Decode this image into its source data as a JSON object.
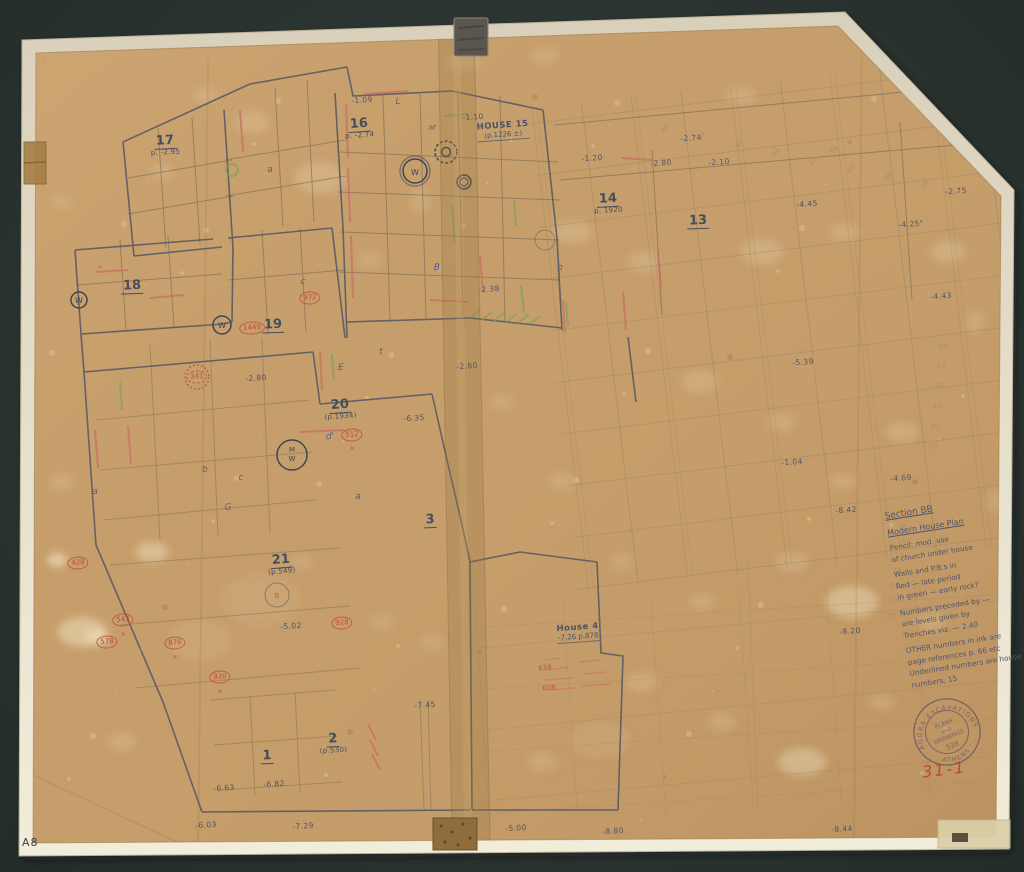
{
  "artifact": {
    "corner_label": "A8",
    "catalog_red": "31-1",
    "stamp": {
      "arc_top": "AGORA EXCAVATIONS",
      "arc_bottom": "· ATHENS ·",
      "line1": "PLANS",
      "line2": "AND",
      "line3": "DRAWINGS",
      "number": "538"
    }
  },
  "colors": {
    "paper": "#c69e6b",
    "border": "#e9e2cf",
    "ink": "#4b5263",
    "pencil": "#6e6452",
    "red_ink": "#bf4136",
    "green_ink": "#7aa05e",
    "stamp_ink": "#6b5a6e"
  },
  "notes": {
    "lines": [
      {
        "t": "Section BB",
        "u": 1,
        "s": 9
      },
      {
        "t": ""
      },
      {
        "t": "Modern House Plan",
        "u": 1,
        "s": 8
      },
      {
        "t": ""
      },
      {
        "t": "Pencil: mod. use"
      },
      {
        "t": "of church under house"
      },
      {
        "t": ""
      },
      {
        "t": "Walls and P.B.s in"
      },
      {
        "t": "Red — late period"
      },
      {
        "t": "in green — early rock?"
      },
      {
        "t": ""
      },
      {
        "t": "Numbers preceded by —"
      },
      {
        "t": "are levels given by"
      },
      {
        "t": "Trenches  viz. — 2.40"
      },
      {
        "t": ""
      },
      {
        "t": "OTHER numbers in ink are"
      },
      {
        "t": "page references  p. 66 etc"
      },
      {
        "t": "Underlined numbers are house"
      },
      {
        "t": "numbers,  15"
      }
    ]
  },
  "plan": {
    "houses": [
      {
        "text": "17",
        "sub": "p. -2.95",
        "x": 165,
        "y": 143,
        "rot": -3
      },
      {
        "text": "16",
        "sub": "p. -2.74",
        "x": 359,
        "y": 126,
        "rot": -4
      },
      {
        "text": "14",
        "sub": "p. 1920",
        "x": 608,
        "y": 201,
        "rot": -3
      },
      {
        "text": "13",
        "x": 698,
        "y": 219,
        "rot": -2
      },
      {
        "text": "18",
        "x": 132,
        "y": 284,
        "rot": -2
      },
      {
        "text": "19",
        "x": 273,
        "y": 323,
        "rot": -2
      },
      {
        "text": "20",
        "sub": "(p.1934)",
        "x": 340,
        "y": 407,
        "rot": -4
      },
      {
        "text": "21",
        "sub": "(p.549)",
        "x": 281,
        "y": 562,
        "rot": -5
      },
      {
        "text": "3",
        "x": 430,
        "y": 518,
        "rot": -2
      },
      {
        "text": "2",
        "sub": "(p.530)",
        "x": 333,
        "y": 741,
        "rot": -3
      },
      {
        "text": "1",
        "x": 267,
        "y": 754,
        "rot": -2
      }
    ],
    "house_labels": [
      {
        "text": "HOUSE 15",
        "sub": "(p.1226 ±)",
        "x": 503,
        "y": 131,
        "rot": -4
      },
      {
        "text": "House 4",
        "sub": "-7.26  p.878",
        "x": 578,
        "y": 633,
        "rot": -4
      }
    ],
    "elevations": [
      {
        "text": "-1.09",
        "x": 362,
        "y": 100
      },
      {
        "text": "-1.10",
        "x": 473,
        "y": 117
      },
      {
        "text": "-1.20",
        "x": 592,
        "y": 158
      },
      {
        "text": "-2.80",
        "x": 661,
        "y": 163
      },
      {
        "text": "-2.10",
        "x": 719,
        "y": 162
      },
      {
        "text": "-2.74",
        "x": 691,
        "y": 138
      },
      {
        "text": "-2.75",
        "x": 956,
        "y": 191
      },
      {
        "text": "-4.45",
        "x": 807,
        "y": 204
      },
      {
        "text": "-4.25\"",
        "x": 911,
        "y": 224
      },
      {
        "text": "-4.43",
        "x": 941,
        "y": 296
      },
      {
        "text": "-5.39",
        "x": 803,
        "y": 362
      },
      {
        "text": "-1.04",
        "x": 792,
        "y": 462
      },
      {
        "text": "-4.69",
        "x": 901,
        "y": 478
      },
      {
        "text": "-8.42",
        "x": 846,
        "y": 510
      },
      {
        "text": "-8.20",
        "x": 850,
        "y": 631
      },
      {
        "text": "-2.38",
        "x": 489,
        "y": 289
      },
      {
        "text": "-2.80",
        "x": 467,
        "y": 366
      },
      {
        "text": "-2.80",
        "x": 256,
        "y": 378
      },
      {
        "text": "-6.35",
        "x": 414,
        "y": 418
      },
      {
        "text": "-5.02",
        "x": 291,
        "y": 626
      },
      {
        "text": "-6.63",
        "x": 224,
        "y": 788
      },
      {
        "text": "-6.82",
        "x": 274,
        "y": 784
      },
      {
        "text": "-6.03",
        "x": 206,
        "y": 825
      },
      {
        "text": "-7.29",
        "x": 303,
        "y": 826
      },
      {
        "text": "-7.45",
        "x": 425,
        "y": 705
      },
      {
        "text": "-5.00",
        "x": 516,
        "y": 828
      },
      {
        "text": "-8.80",
        "x": 613,
        "y": 831
      },
      {
        "text": "-8.44",
        "x": 842,
        "y": 829
      }
    ],
    "finds": [
      {
        "text": "341",
        "x": 197,
        "y": 377,
        "dotted": true
      },
      {
        "text": "1449",
        "x": 252,
        "y": 328
      },
      {
        "text": "972",
        "x": 310,
        "y": 298
      },
      {
        "text": "512",
        "x": 352,
        "y": 435
      },
      {
        "text": "428",
        "x": 78,
        "y": 563
      },
      {
        "text": "543",
        "x": 123,
        "y": 620
      },
      {
        "text": "578",
        "x": 107,
        "y": 642
      },
      {
        "text": "876",
        "x": 175,
        "y": 643
      },
      {
        "text": "920",
        "x": 220,
        "y": 677
      },
      {
        "text": "928",
        "x": 342,
        "y": 623
      }
    ],
    "red_texts": [
      {
        "text": "x",
        "x": 123,
        "y": 634
      },
      {
        "text": "x",
        "x": 175,
        "y": 657
      },
      {
        "text": "x",
        "x": 220,
        "y": 691
      },
      {
        "text": "x",
        "x": 352,
        "y": 448
      },
      {
        "text": "638",
        "x": 545,
        "y": 668
      },
      {
        "text": "608",
        "x": 549,
        "y": 688
      }
    ],
    "letters": [
      {
        "text": "L",
        "x": 398,
        "y": 102
      },
      {
        "text": "a",
        "x": 270,
        "y": 170
      },
      {
        "text": "c",
        "x": 303,
        "y": 282
      },
      {
        "text": "E",
        "x": 341,
        "y": 368
      },
      {
        "text": "t",
        "x": 381,
        "y": 352
      },
      {
        "text": "a",
        "x": 358,
        "y": 497
      },
      {
        "text": "c",
        "x": 241,
        "y": 478
      },
      {
        "text": "G",
        "x": 228,
        "y": 508
      },
      {
        "text": "a",
        "x": 95,
        "y": 492
      },
      {
        "text": "b",
        "x": 205,
        "y": 470
      },
      {
        "text": "d'",
        "x": 330,
        "y": 437
      },
      {
        "text": "B",
        "x": 437,
        "y": 268,
        "color": "#4a5aa0"
      },
      {
        "text": "b",
        "x": 560,
        "y": 268
      },
      {
        "text": "M'",
        "x": 433,
        "y": 128,
        "size": 7
      }
    ],
    "grid_numbers": [
      {
        "text": "35",
        "x": 903,
        "y": 527
      },
      {
        "text": "34",
        "x": 901,
        "y": 541
      },
      {
        "text": "33",
        "x": 899,
        "y": 556
      },
      {
        "text": "32",
        "x": 897,
        "y": 571
      },
      {
        "text": "31",
        "x": 895,
        "y": 586
      },
      {
        "text": "30",
        "x": 893,
        "y": 601
      },
      {
        "text": "29",
        "x": 891,
        "y": 616
      },
      {
        "text": "44",
        "x": 943,
        "y": 346
      },
      {
        "text": "43",
        "x": 941,
        "y": 366
      },
      {
        "text": "42",
        "x": 939,
        "y": 386
      },
      {
        "text": "41",
        "x": 937,
        "y": 406
      },
      {
        "text": "40",
        "x": 935,
        "y": 426
      },
      {
        "text": "39",
        "x": 933,
        "y": 446
      }
    ],
    "top_diagonal_numbers": [
      {
        "text": "45",
        "x": 665,
        "y": 128
      },
      {
        "text": "44",
        "x": 702,
        "y": 136
      },
      {
        "text": "43",
        "x": 739,
        "y": 144
      },
      {
        "text": "42",
        "x": 776,
        "y": 152
      },
      {
        "text": "41",
        "x": 813,
        "y": 161
      },
      {
        "text": "40",
        "x": 851,
        "y": 169
      },
      {
        "text": "39",
        "x": 888,
        "y": 177
      },
      {
        "text": "38",
        "x": 925,
        "y": 185
      },
      {
        "text": "N",
        "x": 835,
        "y": 150,
        "size": 10
      }
    ],
    "wells_note": "circled W symbols mark wells"
  }
}
